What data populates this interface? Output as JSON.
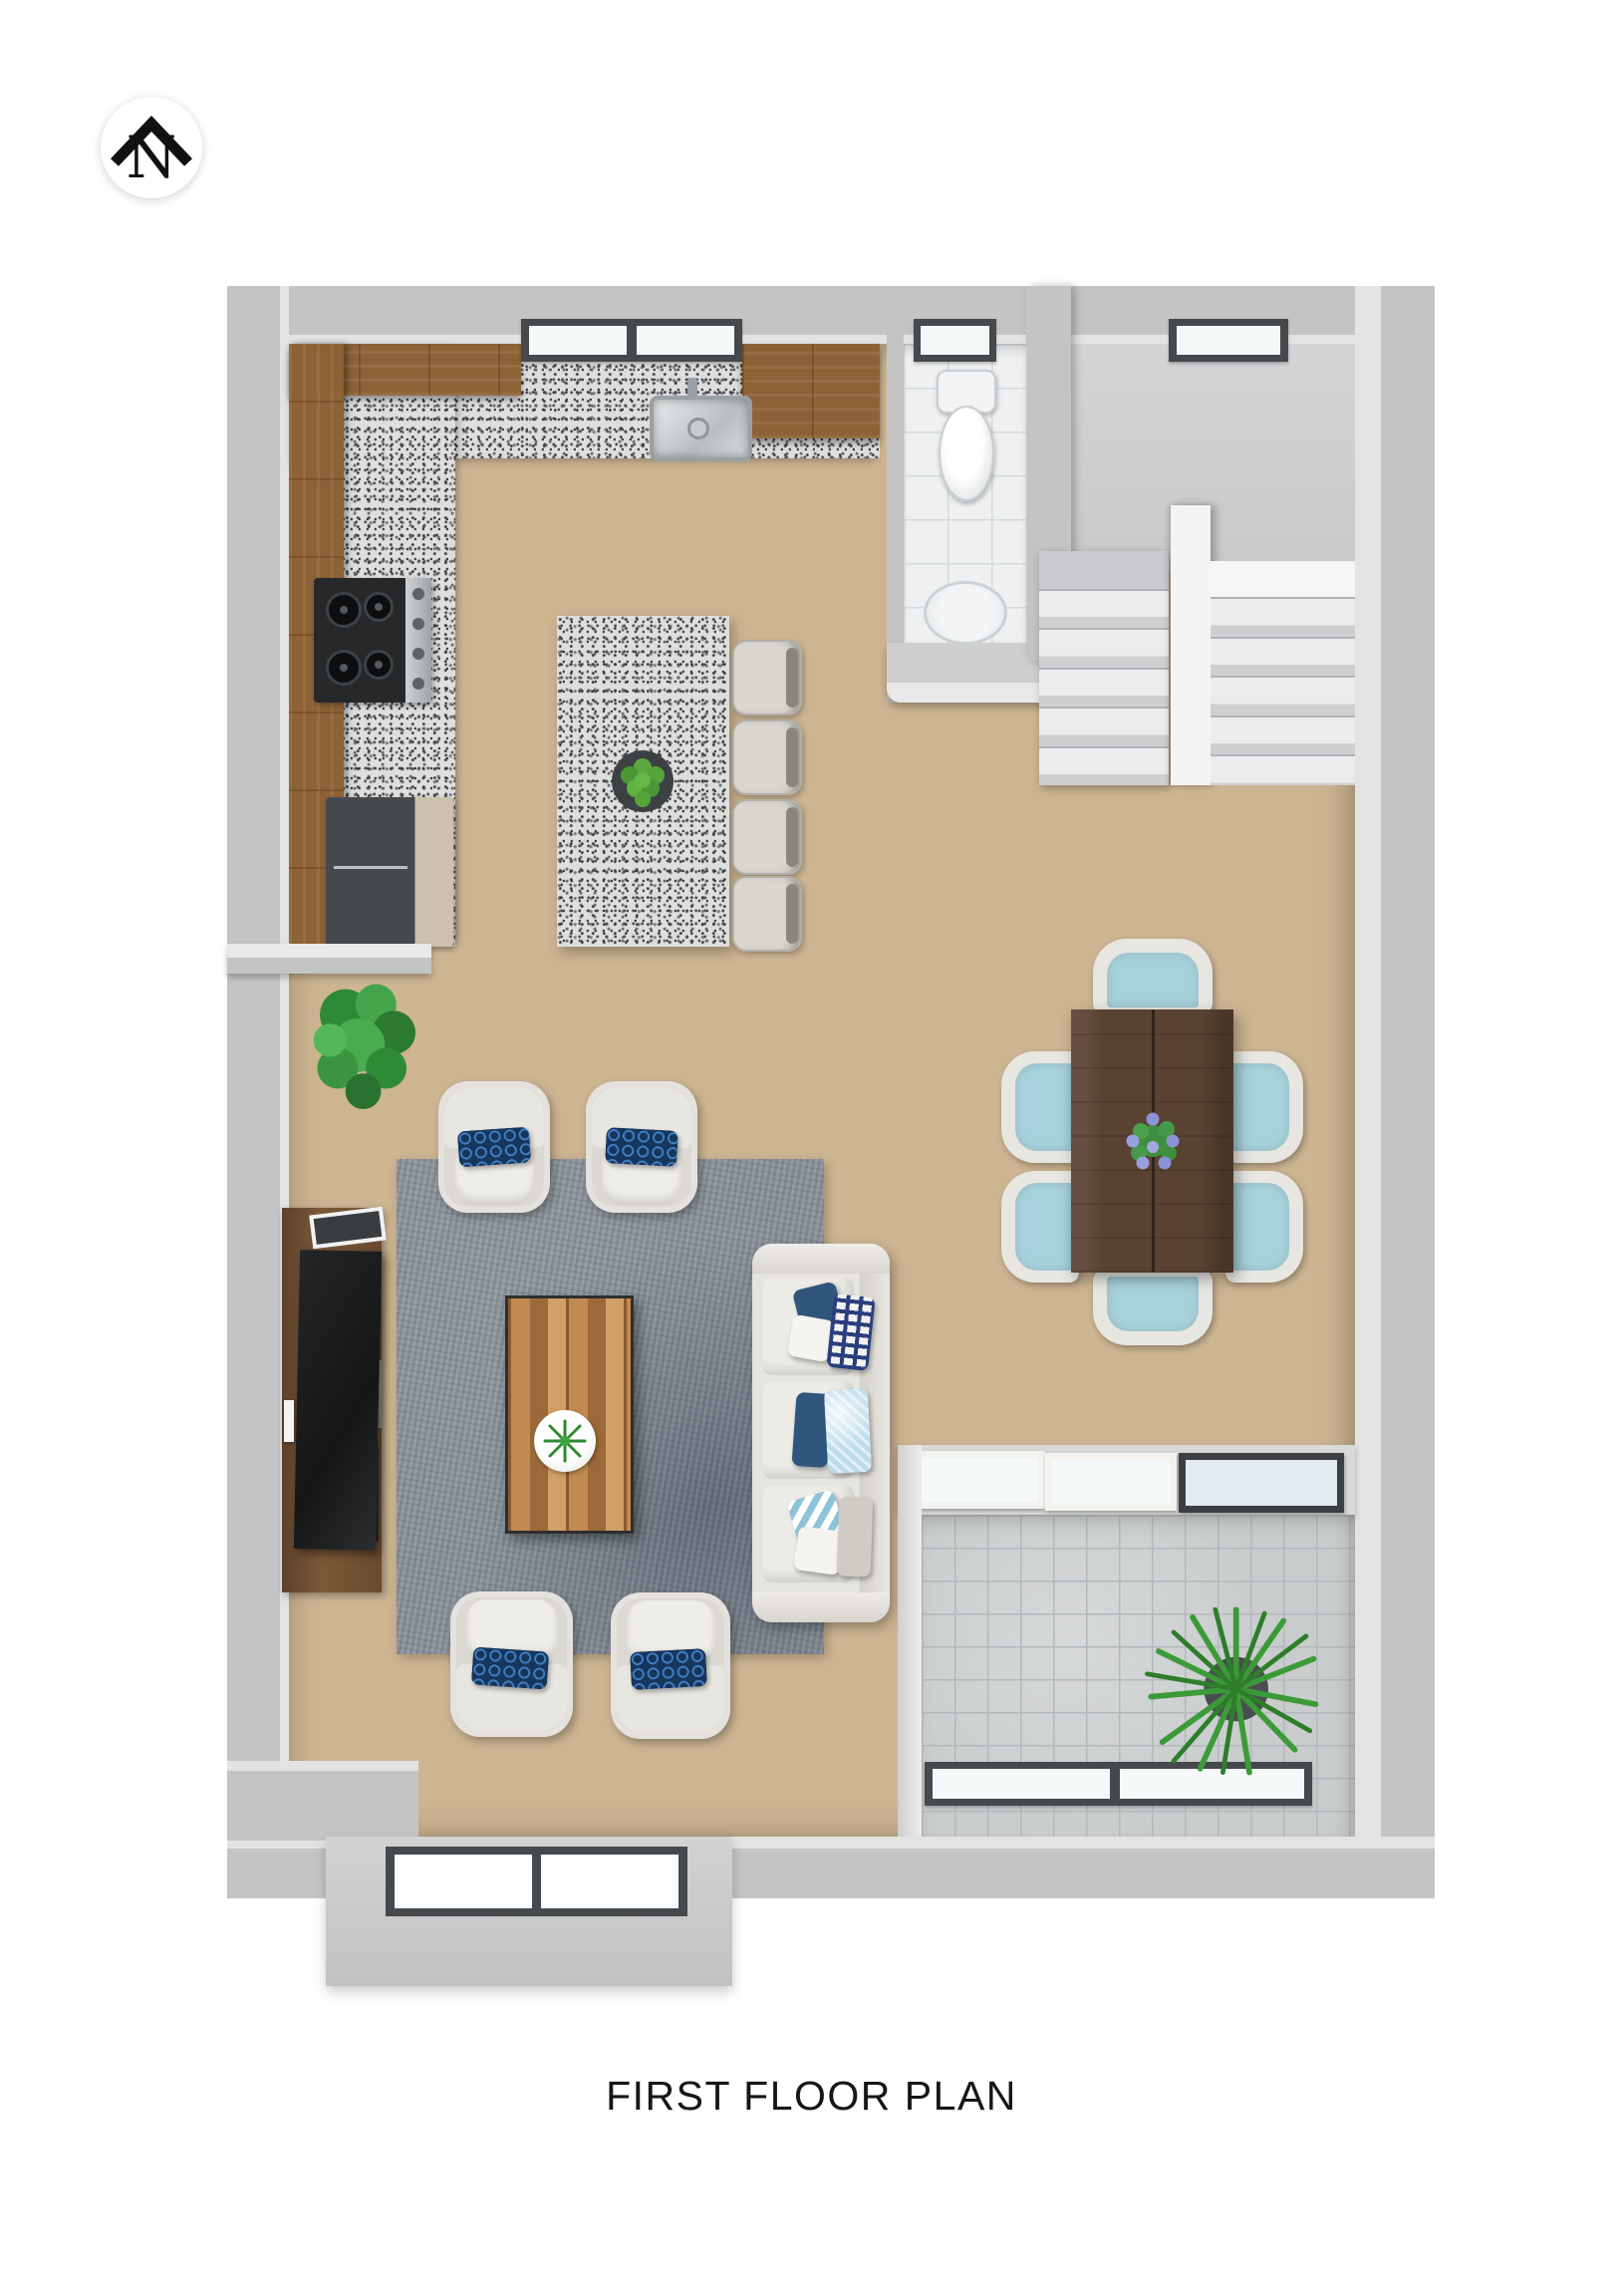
{
  "page": {
    "title": "FIRST FLOOR PLAN",
    "background": "#ffffff"
  },
  "compass": {
    "label": "N",
    "direction": "north-up"
  },
  "palette": {
    "wall": "#c4c4c4",
    "wall_face": "#e3e3e3",
    "wood_floor": "#cdb592",
    "cabinet_wood": "#8d6236",
    "granite": "#dedede",
    "rug": "#8b939c",
    "sofa_cream": "#e6e4df",
    "accent_blue": "#2f6cb0",
    "navy": "#2c4e79",
    "seat_teal": "#a7d2dc",
    "walnut_table": "#5a4232",
    "coffee_wood": "#b17a42",
    "bath_tile": "#eef0f1",
    "patio_tile": "#c9cccd",
    "plant_green": "#3d9b41",
    "window_frame": "#45494c",
    "glass": "#f4f8f9"
  }
}
